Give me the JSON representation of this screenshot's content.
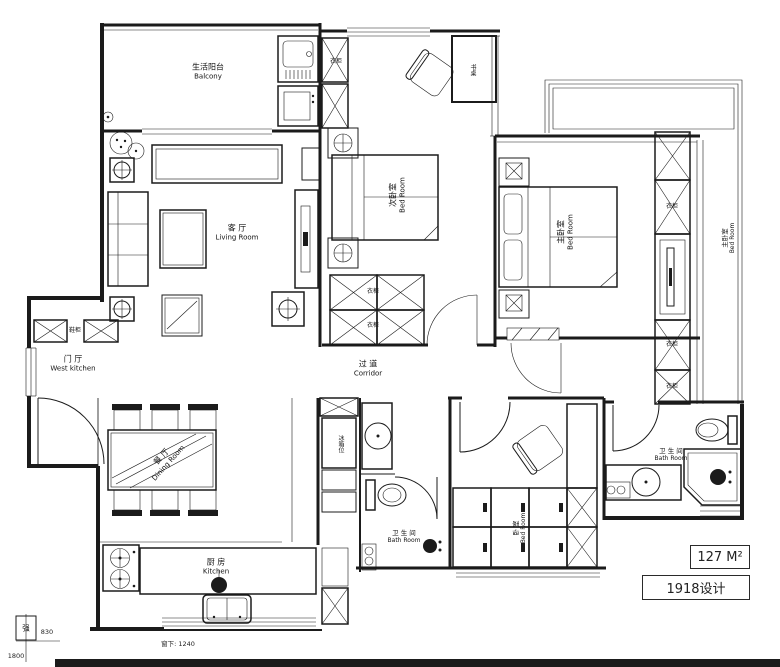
{
  "plan": {
    "rooms": {
      "balcony": {
        "zh": "生活阳台",
        "en": "Balcony"
      },
      "living": {
        "zh": "客 厅",
        "en": "Living Room"
      },
      "bedroom2": {
        "zh": "次卧室",
        "en": "Bed Room"
      },
      "master": {
        "zh": "主卧室",
        "en": "Bed Room"
      },
      "master_side": {
        "zh": "主卧室",
        "en": "Bed Room"
      },
      "entry": {
        "zh": "门 厅",
        "en": "West kitchen"
      },
      "corridor": {
        "zh": "过 道",
        "en": "Corridor"
      },
      "dining": {
        "zh": "餐 厅",
        "en": "Dining Room"
      },
      "kitchen": {
        "zh": "厨 房",
        "en": "Kitchen"
      },
      "bath_mid": {
        "zh": "卫 生 间",
        "en": "Bath Room"
      },
      "bath_master": {
        "zh": "卫 生 间",
        "en": "Bath Room"
      },
      "bedroom3": {
        "zh": "卧 室",
        "en": "Bed Room"
      }
    },
    "fixtures": {
      "wardrobe": "衣柜",
      "shoe_cabinet": "鞋柜",
      "desk": "书桌",
      "fridge": "冰箱位"
    },
    "annotations": {
      "area": "127 M²",
      "brand": "1918设计",
      "window_note": "窗下: 1240",
      "dim_830": "830",
      "dim_1800": "1800",
      "meter": "强"
    },
    "colors": {
      "line": "#1b1b1b",
      "bg": "#ffffff"
    }
  }
}
